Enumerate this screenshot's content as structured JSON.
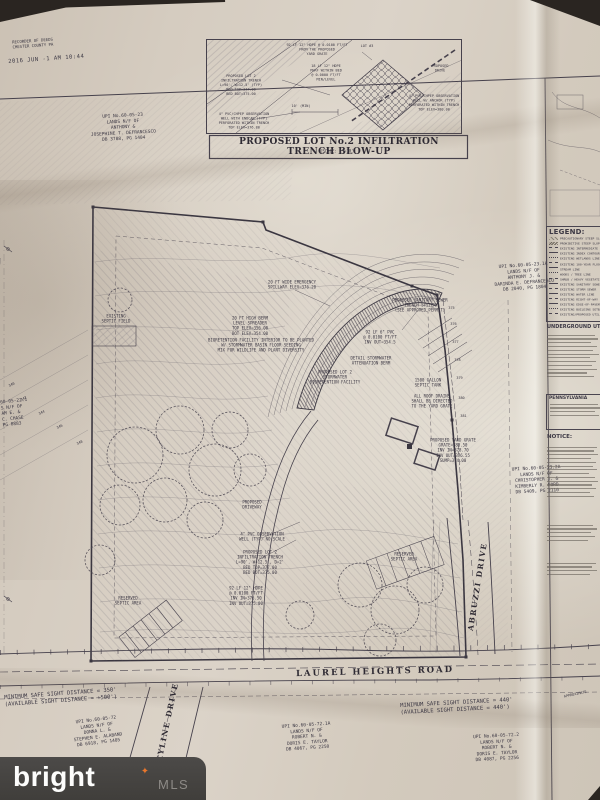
{
  "stamp": {
    "office_lines": "RECORDER OF DEEDS\nCHESTER COUNTY PA",
    "datetime": "2016 JUN -1  AM 10:44"
  },
  "blowup": {
    "title": "PROPOSED LOT No.2 INFILTRATION TRENCH BLOW-UP",
    "scale": "(SCALE: 1\"=10')",
    "labels": {
      "hdpe_from_grate": "92 LF 12\" HDPE @ 0.0100 FT/FT\nFROM THE PROPOSED\nYARD GRATE",
      "lot3": "LOT #3",
      "hdpe_perf": "18 LF 12\" HDPE\nPERF WITHIN BED\n@ 0.0000 FT/FT\nMIN/LEVEL",
      "trench": "PROPOSED LOT 2\nINFILTRATION TRENCH\nL=90', W=12.5' (TYP)\nBED TOP=377.00\nBED BOT=375.00",
      "ten_min": "10' (MIN)",
      "drive": "PROPOSED\nDRIVE",
      "obs_well_left": "4\" PVC/CHPEP OBSERVATION\nWELL WITH ENDCAP (TYP)\nPERFORATED WITHIN TRENCH\nTOP ELEV=376.80",
      "obs_well_right": "4\" PVC/CHPEP OBSERVATION\nWELL W/ ANCHOR (TYP)\nPERFORATED WITHIN TRENCH\nTOP ELEV=380.00"
    }
  },
  "legend": {
    "title": "LEGEND:",
    "items": [
      "PRECAUTIONARY STEEP SLOPES (15% TO 25%)",
      "PROHIBITIVE STEEP SLOPES (GREATER THAN 25%)",
      "EXISTING INTERMEDIATE CONTOUR",
      "EXISTING INDEX CONTOUR",
      "EXISTING WETLANDS LINE",
      "EXISTING 100-YEAR FLOODPLAIN",
      "STREAM LINE",
      "WOODS / TREE LINE",
      "SHRUB / HEAVY VEGETATION",
      "EXISTING SANITARY SEWER",
      "EXISTING STORM SEWER",
      "EXISTING WATER LINE",
      "EXISTING RIGHT-OF-WAY",
      "EXISTING EDGE-OF-PAVEMENT",
      "EXISTING BUILDING SETBACK",
      "EXISTING/PROPOSED UTILITY"
    ],
    "underground_title": "UNDERGROUND UTILITIES",
    "penn_title": "PENNSYLVANIA",
    "notice_title": "NOTICE:"
  },
  "parcels": {
    "defrancesco_top": "UPI No.60-05-23\nLANDS N/F OF\nANTHONY &\nJOSEPHINE T. DEFRANCESCO\nDB 3788, PG 1404",
    "chase_left": "60-05-22.1\nS N/F OF\nAM E. &\nC. CHASE\nPG 0883",
    "defrancesco_right": "UPI No.60-05-23.1A\nLANDS N/F OF\nANTHONY J. &\nDARINDA E. DEFRANCESCO\nDB 2040, PG 1804",
    "ford": "UPI No.60-05-23.2A\nLANDS N/F OF\nCHRISTOPHER J. &\nKIMBERLY R. FORD\nDB 5409, PG 2110",
    "alaband": "UPI No.60-05-72\nLANDS N/F OF\nDONNA L. &\nSTEPHEN E. ALABAND\nDB 6918, PG 1405",
    "taylor_1a": "UPI No.60-05-72.1A\nLANDS N/F OF\nROBERT N. &\nDORIS E. TAYLOR\nDB 4067, PG 2250",
    "taylor_2": "UPI No.60-05-72.2\nLANDS N/F OF\nROBERT N. &\nDORIS E. TAYLOR\nDB 4087, PG 2256"
  },
  "roads": {
    "laurel": "LAUREL HEIGHTS ROAD",
    "skyline": "SKYLINE DRIVE",
    "abruzzi": "ABRUZZI DRIVE",
    "approximate": "APPROXIMATE"
  },
  "notes": {
    "sight_left": "MINIMUM SAFE SIGHT DISTANCE = 350'\n(AVAILABLE SIGHT DISTANCE = +500')",
    "sight_right": "MINIMUM SAFE SIGHT DISTANCE = 440'\n(AVAILABLE SIGHT DISTANCE = 440')"
  },
  "site_labels": {
    "spillway": "20 FT WIDE EMERGENCY\nSPILLWAY ELEV=376.20",
    "berm_spreader": "20 FT HIGH BERM\nLEVEL SPREADER\nTOP ELEV=356.00\nBOT ELEV=354.00",
    "bioretention_note": "BIORETENTION FACILITY INTERIOR TO BE PLANTED\nW/ STORMWATER BASIN FLOOR SEEDING\nMIX FOR WILDLIFE AND PLANT DIVERSITY",
    "bioretention_facility": "PROPOSED LOT 2\nSTORMWATER\nBIORETENTION FACILITY",
    "pvc6": "92 LF 6\" PVC\n@ 0.0100 FT/FT\nINV OUT=354.5",
    "attenuation": "DETAIL STORMWATER\nATTENUATION BERM",
    "sanitary": "PROPOSED SANITARY SEWER\nTRENCH SYSTEM\n(SEE APPROVED PERMIT)",
    "roof_drains": "ALL ROOF DRAINS\nSHALL BE DIRECTED\nTO THE YARD GRATE",
    "septic_tank": "1500 GALLON\nSEPTIC TANK",
    "yard_grate": "PROPOSED YARD GRATE\nGRATE=380.50\nINV IN=378.70\nINV OUT=376.55\nSUMP=374.00",
    "obs_well": "4\" PVC OBSERVATION\nWELL (TYP) NO SCALE",
    "trench_main": "PROPOSED LOT 2\nINFILTRATION TRENCH\nL=90', W=12.5', D=2'\nBED TOP=377.00\nBED BOT=375.00",
    "hdpe_main": "92 LF 12\" HDPE\n@ 0.0100 FT/FT\nINV IN=376.50\nINV OUT=375.00",
    "reserved_septic_left": "RESERVED\nSEPTIC AREA",
    "reserved_septic_right": "RESERVED\nSEPTIC AREA",
    "existing_septic": "EXISTING\nSEPTIC FIELD",
    "driveway": "PROPOSED\nDRIVEWAY",
    "ohw": "OHW"
  },
  "contours": {
    "left": [
      "340",
      "342",
      "344",
      "346",
      "348"
    ],
    "right": [
      "375",
      "376",
      "377",
      "378",
      "379",
      "380",
      "381"
    ]
  },
  "watermark": {
    "brand": "bright",
    "star": "✦",
    "suffix": "MLS"
  }
}
